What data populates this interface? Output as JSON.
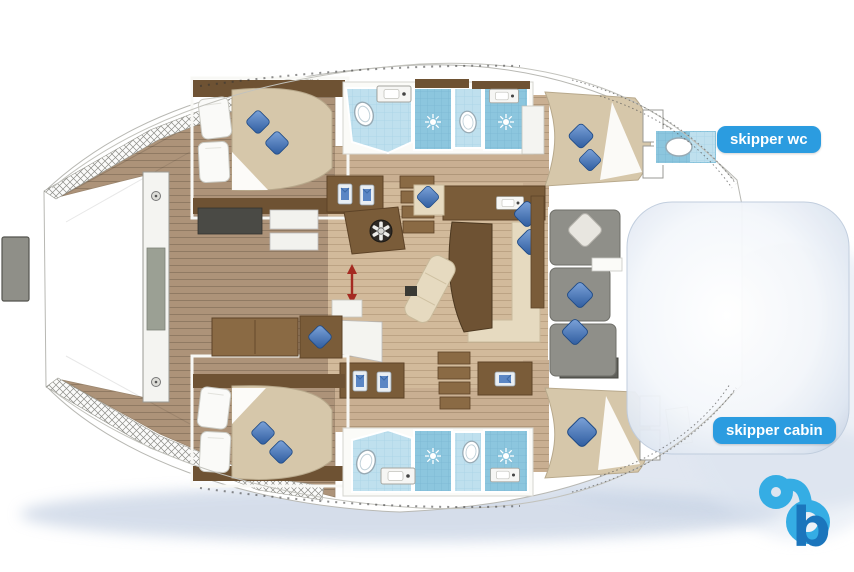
{
  "plan": {
    "type": "catamaran-floorplan",
    "badges": [
      {
        "id": "skipper-wc",
        "label": "skipper wc"
      },
      {
        "id": "skipper-cabin",
        "label": "skipper cabin"
      }
    ],
    "logo": {
      "letter": "b",
      "color_light": "#35ADE4",
      "color_dark": "#1B75BC"
    },
    "colors": {
      "badge_blue": "#2B9CE0",
      "badge_text": "#FFFFFF",
      "deck_wood": "#AD9379",
      "cabin_wood": "#C9AF92",
      "saloon_wood": "#D2BA9B",
      "dark_wood": "#6E5233",
      "furniture_wood": "#7A5C39",
      "mattress_tan": "#D6C7AA",
      "cushion_blue": "#3E6FB4",
      "bathroom_tile": "#BFE0EE",
      "shower_tile": "#8CC6DE",
      "sofa_gray": "#8F8F89",
      "sofa_cream": "#E6DAC0",
      "water_shadow": "#B4C3DA"
    },
    "icons": {
      "helm_wheel_icon": "circle-with-spokes",
      "shower_drain_icon": "starburst",
      "toilet_icon": "double-oval",
      "sink_icon": "rect-with-faucet-dot",
      "locker_item_icon": "folded-garment",
      "cushion_icon": "rotated-diamond",
      "companionway_arrow_icon": "red-double-arrow",
      "screw_icon": "dotted-circle"
    }
  }
}
